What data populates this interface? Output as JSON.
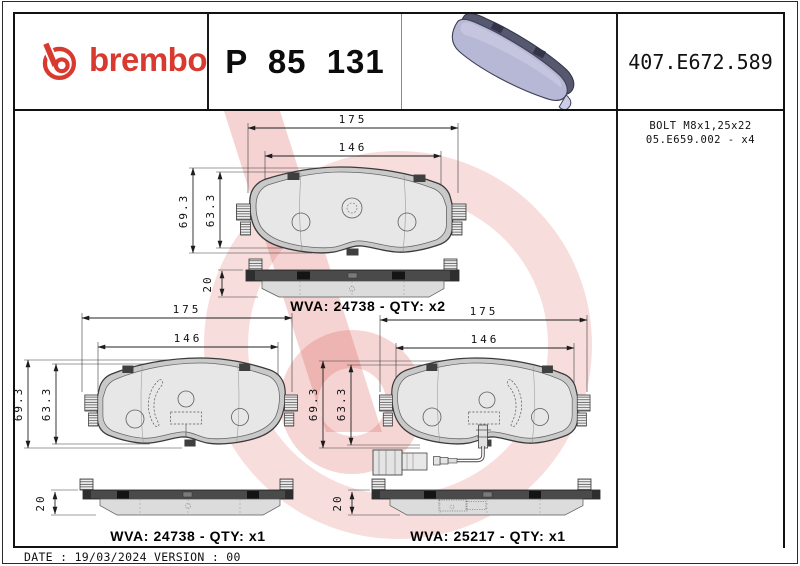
{
  "header": {
    "brand_wordmark": "brembo",
    "part_number": "P 85 131",
    "reference_number": "407.E672.589"
  },
  "accessory": {
    "line1": "BOLT M8x1,25x22",
    "line2": "05.E659.002 - x4"
  },
  "drawings": {
    "top": {
      "dim_width_outer": "175",
      "dim_width_inner": "146",
      "dim_height_outer": "69.3",
      "dim_height_inner": "63.3",
      "dim_thickness": "20",
      "label": "WVA: 24738 - QTY: x2"
    },
    "bottom_left": {
      "dim_width_outer": "175",
      "dim_width_inner": "146",
      "dim_height_outer": "69.3",
      "dim_height_inner": "63.3",
      "dim_thickness": "20",
      "label": "WVA: 24738 - QTY: x1"
    },
    "bottom_right": {
      "dim_width_outer": "175",
      "dim_width_inner": "146",
      "dim_height_outer": "69.3",
      "dim_height_inner": "63.3",
      "dim_thickness": "20",
      "label": "WVA: 25217 - QTY: x1"
    }
  },
  "footer": {
    "date_version": "DATE : 19/03/2024 VERSION : 00"
  },
  "colors": {
    "brand_red": "#d93a30",
    "watermark_pink": "#d85550",
    "pad_face_lavender": "#b7b8d6",
    "pad_plate_slate": "#53556a"
  }
}
